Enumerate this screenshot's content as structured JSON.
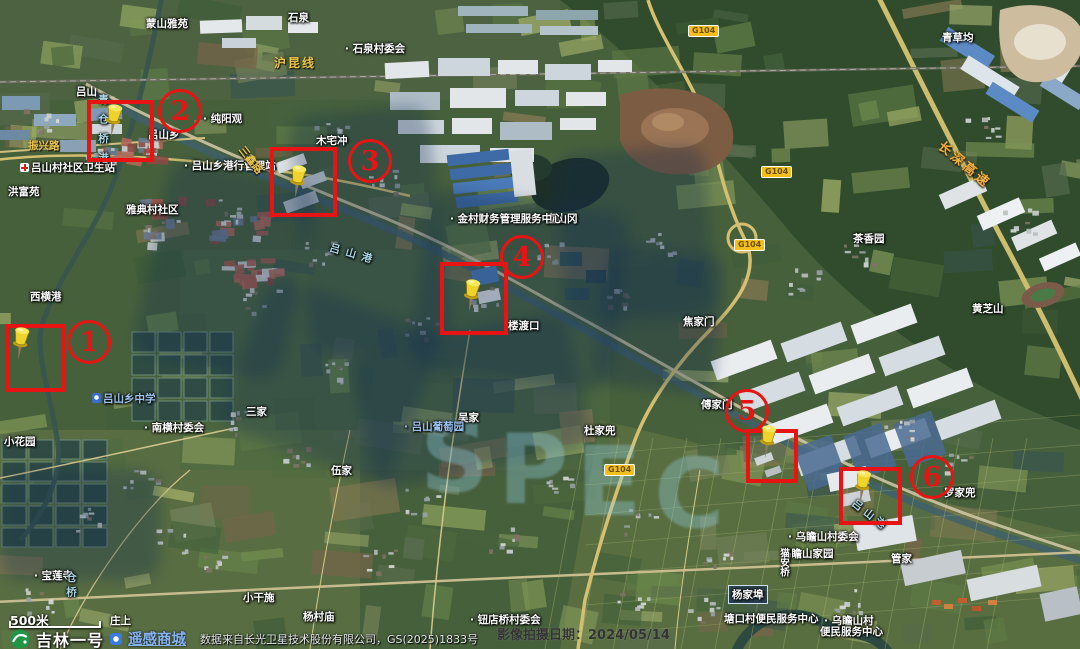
{
  "footer": {
    "scale": "500米",
    "logo": "吉林一号",
    "store": "遥感商城",
    "attribution": "数据来自长光卫星技术股份有限公司，GS(2025)1833号"
  },
  "capture_date": "影像拍摄日期：2024/05/14",
  "watermark": {
    "letters": [
      "S",
      "P",
      "E",
      "C"
    ]
  },
  "colors": {
    "annotation_red": "#e81414",
    "pin_yellow": "#efd32a",
    "poi_blue": "#9cc3f0",
    "water_blue": "#a9d6e6",
    "road_yellow": "#e6c54e",
    "expressway_orange": "#f0b042",
    "shield_yellow": "#f2bf1c"
  },
  "shields": [
    {
      "text": "G104",
      "x": 688,
      "y": 25
    },
    {
      "text": "G104",
      "x": 761,
      "y": 166
    },
    {
      "text": "G104",
      "x": 734,
      "y": 239
    },
    {
      "text": "G104",
      "x": 604,
      "y": 464
    }
  ],
  "labels": [
    {
      "t": "石泉",
      "x": 288,
      "y": 10
    },
    {
      "t": "· 石泉村委会",
      "x": 345,
      "y": 41
    },
    {
      "t": "蒙山雅苑",
      "x": 146,
      "y": 16
    },
    {
      "t": "· 纯阳观",
      "x": 203,
      "y": 111
    },
    {
      "t": "吕山乡",
      "x": 148,
      "y": 127
    },
    {
      "t": "· 吕山乡港行管理站",
      "x": 184,
      "y": 158
    },
    {
      "t": "木宅冲",
      "x": 316,
      "y": 133
    },
    {
      "t": "吕山村社区卫生站",
      "x": 20,
      "y": 160,
      "icon": "cross"
    },
    {
      "t": "洪富苑",
      "x": 8,
      "y": 184
    },
    {
      "t": "雅典村社区",
      "x": 126,
      "y": 202
    },
    {
      "t": "青草均",
      "x": 942,
      "y": 30
    },
    {
      "t": "茶香园",
      "x": 853,
      "y": 231
    },
    {
      "t": "黄芝山",
      "x": 972,
      "y": 301
    },
    {
      "t": "焦家门",
      "x": 683,
      "y": 314
    },
    {
      "t": "楼渡口",
      "x": 508,
      "y": 318
    },
    {
      "t": "傅家门",
      "x": 701,
      "y": 397
    },
    {
      "t": "吴家",
      "x": 458,
      "y": 410
    },
    {
      "t": "杜家兜",
      "x": 584,
      "y": 423
    },
    {
      "t": "· 南横村委会",
      "x": 144,
      "y": 420
    },
    {
      "t": "三家",
      "x": 246,
      "y": 404
    },
    {
      "t": "伍家",
      "x": 331,
      "y": 463
    },
    {
      "t": "西横港",
      "x": 30,
      "y": 289
    },
    {
      "t": "小花园",
      "x": 4,
      "y": 434
    },
    {
      "t": "· 宝莲寺",
      "x": 34,
      "y": 568
    },
    {
      "t": "庄上",
      "x": 110,
      "y": 613
    },
    {
      "t": "小干施",
      "x": 243,
      "y": 590
    },
    {
      "t": "杨村庙",
      "x": 303,
      "y": 609
    },
    {
      "t": "· 钮店桥村委会",
      "x": 470,
      "y": 612
    },
    {
      "t": "塘口村便民服务中心",
      "x": 724,
      "y": 611
    },
    {
      "t": "· 乌瞻山村委会",
      "x": 788,
      "y": 529
    },
    {
      "t": "乌瞻山家园",
      "x": 781,
      "y": 546
    },
    {
      "t": "管家",
      "x": 891,
      "y": 551
    },
    {
      "t": "· 乌瞻山村",
      "x": 824,
      "y": 613
    },
    {
      "t": "便民服务中心",
      "x": 820,
      "y": 624
    },
    {
      "t": "罗家兜",
      "x": 944,
      "y": 485
    },
    {
      "t": "富山冈",
      "x": 546,
      "y": 211
    },
    {
      "t": "· 金村财务管理服务中心",
      "x": 450,
      "y": 211
    },
    {
      "t": "吕山",
      "x": 76,
      "y": 84
    },
    {
      "t": "猫安桥",
      "x": 776,
      "y": 548,
      "v": true,
      "fs": 9.5
    },
    {
      "t": "杨家埠",
      "x": 728,
      "y": 585,
      "c": "boxed"
    },
    {
      "t": "吕山港",
      "x": 332,
      "y": 240,
      "c": "water",
      "r": 16,
      "ls": 6
    },
    {
      "t": "吕山港",
      "x": 858,
      "y": 496,
      "c": "water",
      "r": 38,
      "ls": 4
    },
    {
      "t": "青仓桥港",
      "x": 96,
      "y": 94,
      "c": "water",
      "v": true,
      "ls": 9
    },
    {
      "t": "仓桥",
      "x": 64,
      "y": 572,
      "c": "water",
      "v": true,
      "ls": 4
    },
    {
      "t": "· 吕山葡萄园",
      "x": 404,
      "y": 419,
      "c": "poi"
    },
    {
      "t": "吕山乡中学",
      "x": 92,
      "y": 391,
      "c": "poi",
      "icon": "school"
    },
    {
      "t": "沪昆线",
      "x": 274,
      "y": 54,
      "c": "road",
      "fs": 12,
      "ls": 2
    },
    {
      "t": "振兴路",
      "x": 28,
      "y": 138,
      "c": "road"
    },
    {
      "t": "三鑫路",
      "x": 247,
      "y": 143,
      "c": "road",
      "r": 52
    },
    {
      "t": "长深高速",
      "x": 947,
      "y": 136,
      "c": "expwy",
      "r": 40,
      "fs": 13,
      "ls": 3
    }
  ],
  "annotations": {
    "boxes": [
      {
        "n": "1",
        "box": [
          6,
          324,
          60,
          68
        ],
        "num": [
          89,
          342
        ],
        "pin": [
          21,
          360
        ]
      },
      {
        "n": "2",
        "box": [
          87,
          100,
          67,
          62
        ],
        "num": [
          180,
          111
        ],
        "pin": [
          114,
          137
        ]
      },
      {
        "n": "3",
        "box": [
          270,
          147,
          67,
          70
        ],
        "num": [
          370,
          161
        ],
        "pin": [
          298,
          198
        ]
      },
      {
        "n": "4",
        "box": [
          440,
          262,
          68,
          73
        ],
        "num": [
          522,
          257
        ],
        "pin": [
          472,
          312
        ]
      },
      {
        "n": "5",
        "box": [
          746,
          429,
          52,
          54
        ],
        "num": [
          747,
          411
        ],
        "pin": [
          768,
          458
        ]
      },
      {
        "n": "6",
        "box": [
          839,
          467,
          63,
          58
        ],
        "num": [
          932,
          477
        ],
        "pin": [
          863,
          503
        ]
      }
    ]
  }
}
